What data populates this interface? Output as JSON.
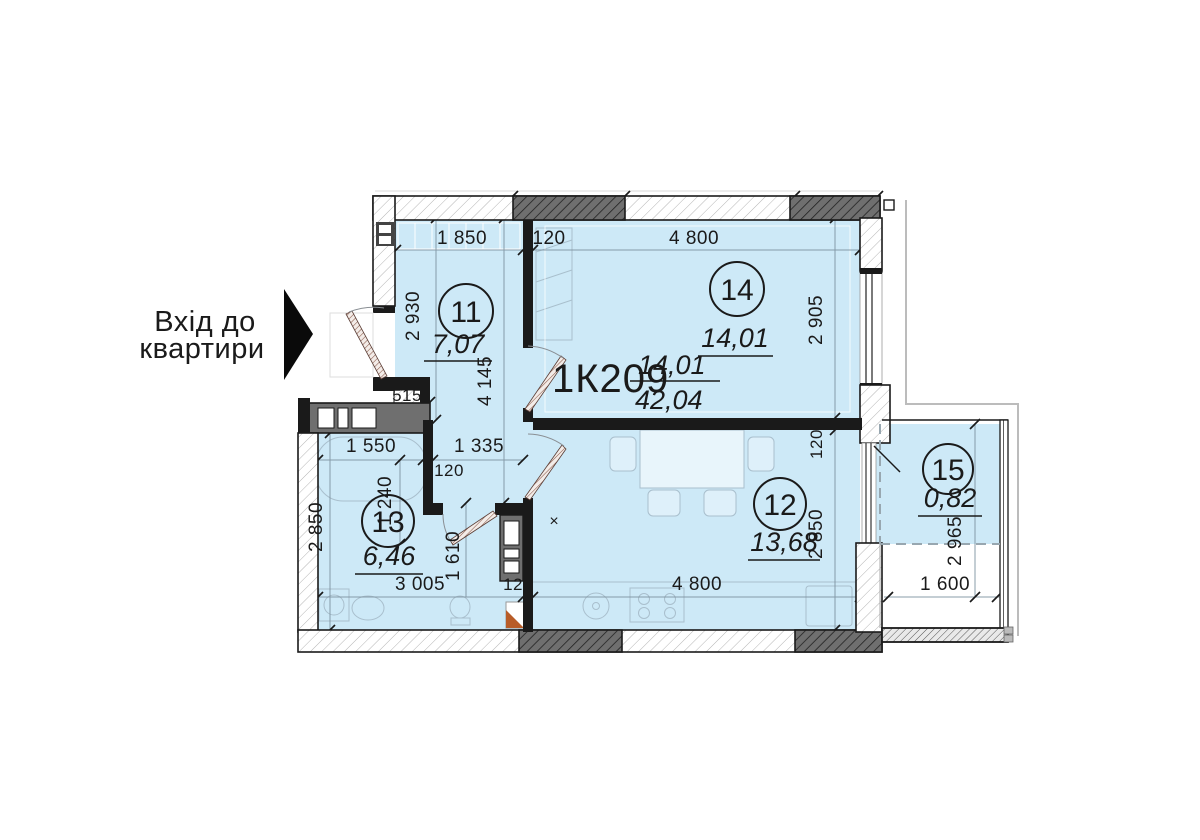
{
  "entrance": {
    "line1": "Вхід до",
    "line2": "квартири"
  },
  "unit": {
    "code": "1К209",
    "numerator": "14,01",
    "denominator": "42,04"
  },
  "rooms": {
    "r11": {
      "number": "11",
      "area": "7,07"
    },
    "r14": {
      "number": "14",
      "area": "14,01"
    },
    "r12": {
      "number": "12",
      "area": "13,68"
    },
    "r13": {
      "number": "13",
      "area": "6,46"
    },
    "r15": {
      "number": "15",
      "area": "0,82"
    }
  },
  "dims": {
    "top_1850": "1 850",
    "top_120": "120",
    "top_4800": "4 800",
    "left_2930": "2 930",
    "left_4145": "4 145",
    "jog_515": "515",
    "mid_1550": "1 550",
    "mid_1335": "1 335",
    "mid_120": "120",
    "mid_1240": "1 240",
    "bath_2850": "2 850",
    "bottom_3005": "3 005",
    "bottom_120": "120",
    "bottom_4800": "4 800",
    "bottom_1610": "1 610",
    "right_2905": "2 905",
    "right_120": "120",
    "right_2850": "2 850",
    "balc_2965": "2 965",
    "balc_1600": "1 600",
    "x_marker": "×"
  },
  "colors": {
    "room_fill": "#cde9f7",
    "wall": "#1a1a1a",
    "dark_block": "#6f6f6f",
    "dim_line": "#7e93a0",
    "contour_gray": "#bcbcbc",
    "accent_orange": "#b85c28"
  }
}
